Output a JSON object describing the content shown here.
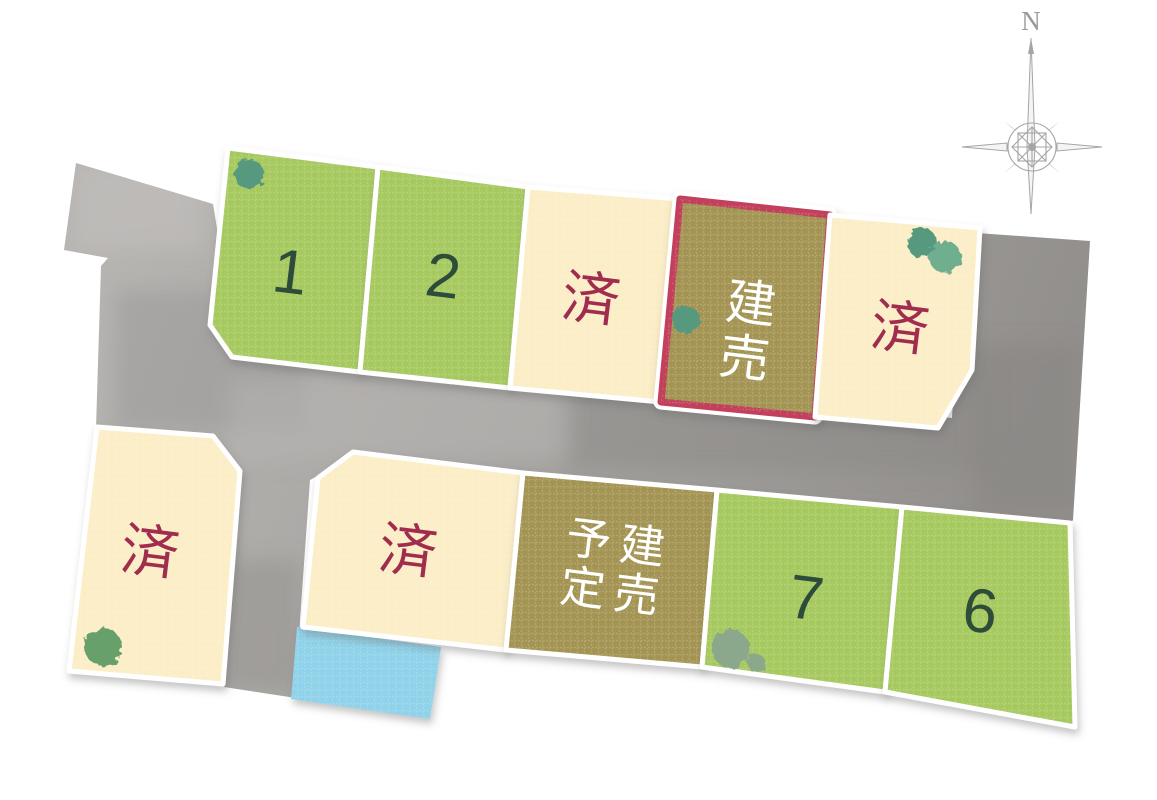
{
  "compass": {
    "north_label": "N"
  },
  "lots": [
    {
      "id": "1",
      "label": "1",
      "status": "available"
    },
    {
      "id": "2",
      "label": "2",
      "status": "available"
    },
    {
      "id": "3",
      "label": "済",
      "status": "sold"
    },
    {
      "id": "4",
      "label": "建売",
      "status": "built-for-sale",
      "highlighted": true
    },
    {
      "id": "5",
      "label": "済",
      "status": "sold"
    },
    {
      "id": "west",
      "label": "済",
      "status": "sold"
    },
    {
      "id": "8",
      "label": "済",
      "status": "sold"
    },
    {
      "id": "9",
      "label": "建売\n予定",
      "status": "built-for-sale-planned"
    },
    {
      "id": "7",
      "label": "7",
      "status": "available"
    },
    {
      "id": "6",
      "label": "6",
      "status": "available"
    }
  ],
  "colors": {
    "lot-green": "#a6c95f",
    "number-text": "#2e4c3a",
    "lot-cream": "#fbedc6",
    "sold-text": "#a02c4e",
    "lot-olive": "#a39452",
    "highlight-border": "#c23f5b",
    "label-white": "#ffffff",
    "road-gray": "#a7a5a2",
    "pond-blue": "#8fd2e9",
    "tree-teal": "#57997f",
    "tree-teal-light": "#6fae90",
    "tree-green": "#68a06c",
    "tree-sage": "#8ba78c",
    "compass-gray": "#a5a5a5",
    "lot-border": "#ffffff"
  }
}
